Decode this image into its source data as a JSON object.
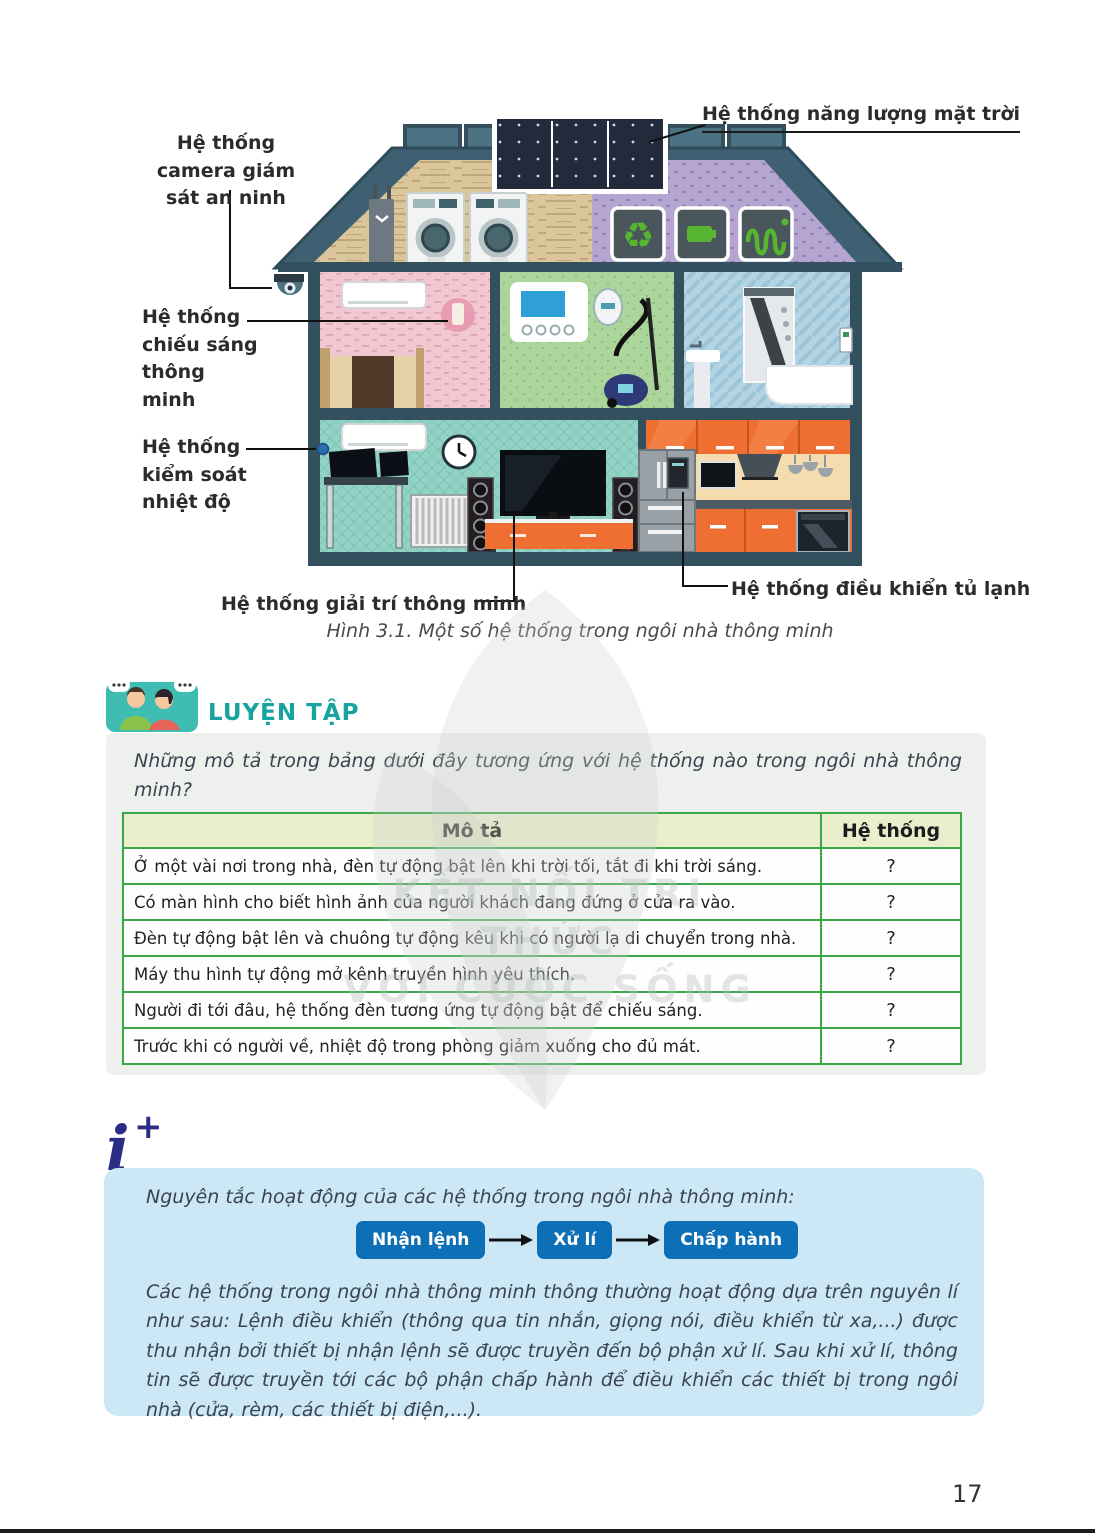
{
  "page": {
    "number": "17"
  },
  "watermark": {
    "line1": "KẾT NỐI TRI THỨC",
    "line2": "VỚI CUỘC SỐNG"
  },
  "figure": {
    "caption": "Hình 3.1. Một số hệ thống trong ngôi nhà thông minh",
    "labels": {
      "camera": "Hệ thống camera giám sát an ninh",
      "solar": "Hệ thống năng lượng mặt trời",
      "lighting": "Hệ thống chiếu sáng thông minh",
      "temperature": "Hệ thống kiểm soát nhiệt độ",
      "entertainment": "Hệ thống giải trí thông minh",
      "fridge": "Hệ thống điều khiển tủ lạnh"
    }
  },
  "practice": {
    "heading": "LUYỆN TẬP",
    "question": "Những mô tả trong bảng dưới đây tương ứng với hệ thống nào trong ngôi nhà thông minh?",
    "table": {
      "headers": [
        "Mô tả",
        "Hệ thống"
      ],
      "rows": [
        {
          "desc": "Ở một vài nơi trong nhà, đèn tự động bật lên khi trời tối, tắt đi khi trời sáng.",
          "answer": "?"
        },
        {
          "desc": "Có màn hình cho biết hình ảnh của người khách đang đứng ở cửa ra vào.",
          "answer": "?"
        },
        {
          "desc": "Đèn tự động bật lên và chuông tự động kêu khi có người lạ di chuyển trong nhà.",
          "answer": "?"
        },
        {
          "desc": "Máy thu hình tự động mở kênh truyền hình yêu thích.",
          "answer": "?"
        },
        {
          "desc": "Người đi tới đâu, hệ thống đèn tương ứng tự động bật để chiếu sáng.",
          "answer": "?"
        },
        {
          "desc": "Trước khi có người về, nhiệt độ trong phòng giảm xuống cho đủ mát.",
          "answer": "?"
        }
      ]
    }
  },
  "info": {
    "intro": "Nguyên tắc hoạt động của các hệ thống trong ngôi nhà thông minh:",
    "flow": {
      "steps": [
        "Nhận lệnh",
        "Xử lí",
        "Chấp hành"
      ]
    },
    "body": "Các hệ thống trong ngôi nhà thông minh thông thường hoạt động dựa trên nguyên lí như sau: Lệnh điều khiển (thông qua tin nhắn, giọng nói, điều khiển từ xa,...) được thu nhận bởi thiết bị nhận lệnh sẽ được truyền đến bộ phận xử lí. Sau khi xử lí, thông tin sẽ được truyền tới các bộ phận chấp hành để điều khiển các thiết bị trong ngôi nhà (cửa, rèm, các thiết bị điện,...)."
  },
  "icons": {
    "practice": "students-talking-icon",
    "info": "info-plus-icon",
    "recycle": "recycle-icon",
    "battery": "battery-icon",
    "heating": "heating-coil-icon"
  },
  "colors": {
    "heading_teal": "#17a39e",
    "table_border_green": "#3aa74b",
    "table_header_bg": "#e9efcc",
    "info_box_bg": "#cce7f5",
    "flow_button_blue": "#0d70b7",
    "info_icon_navy": "#2b2d85",
    "kitchen_orange": "#ee6f31"
  }
}
